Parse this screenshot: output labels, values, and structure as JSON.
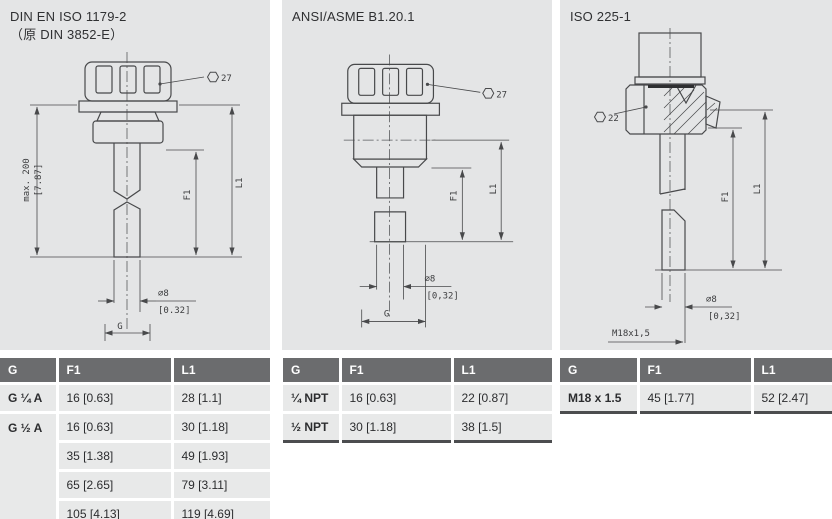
{
  "colors": {
    "panel_bg": "#e4e5e6",
    "table_header_bg": "#6b6c6e",
    "table_row_bg": "#e8e9e9",
    "table_bottom_border": "#4c4d4f",
    "drawing_line": "#48494b",
    "text": "#2f3032"
  },
  "panels": [
    {
      "title_line1": "DIN EN ISO 1179-2",
      "title_line2": "（原 DIN 3852-E）",
      "drawing": {
        "wrench_size": "27",
        "max_length": "max. 200",
        "max_length_inch": "[7.87]",
        "dim_l1": "L1",
        "dim_f1": "F1",
        "dia": "∅8",
        "dia_inch": "[0.32]",
        "thread": "G"
      },
      "table": {
        "headers": [
          "G",
          "F1",
          "L1"
        ],
        "rows": [
          [
            "G ¼ A",
            "16 [0.63]",
            "28 [1.1]"
          ],
          [
            "G ½ A",
            "16 [0.63]",
            "30 [1.18]"
          ],
          [
            "",
            "35 [1.38]",
            "49 [1.93]"
          ],
          [
            "",
            "65 [2.65]",
            "79 [3.11]"
          ],
          [
            "",
            "105 [4.13]",
            "119 [4.69]"
          ]
        ]
      }
    },
    {
      "title_line1": "ANSI/ASME B1.20.1",
      "title_line2": "",
      "drawing": {
        "wrench_size": "27",
        "dim_l1": "L1",
        "dim_f1": "F1",
        "dia": "∅8",
        "dia_inch": "[0,32]",
        "thread": "G"
      },
      "table": {
        "headers": [
          "G",
          "F1",
          "L1"
        ],
        "rows": [
          [
            "¼ NPT",
            "16 [0.63]",
            "22 [0.87]"
          ],
          [
            "½ NPT",
            "30 [1.18]",
            "38 [1.5]"
          ]
        ]
      }
    },
    {
      "title_line1": "ISO 225-1",
      "title_line2": "",
      "drawing": {
        "wrench_size": "22",
        "dim_l1": "L1",
        "dim_f1": "F1",
        "dia": "∅8",
        "dia_inch": "[0,32]",
        "thread": "M18x1,5"
      },
      "table": {
        "headers": [
          "G",
          "F1",
          "L1"
        ],
        "rows": [
          [
            "M18 x 1.5",
            "45 [1.77]",
            "52 [2.47]"
          ]
        ]
      }
    }
  ]
}
